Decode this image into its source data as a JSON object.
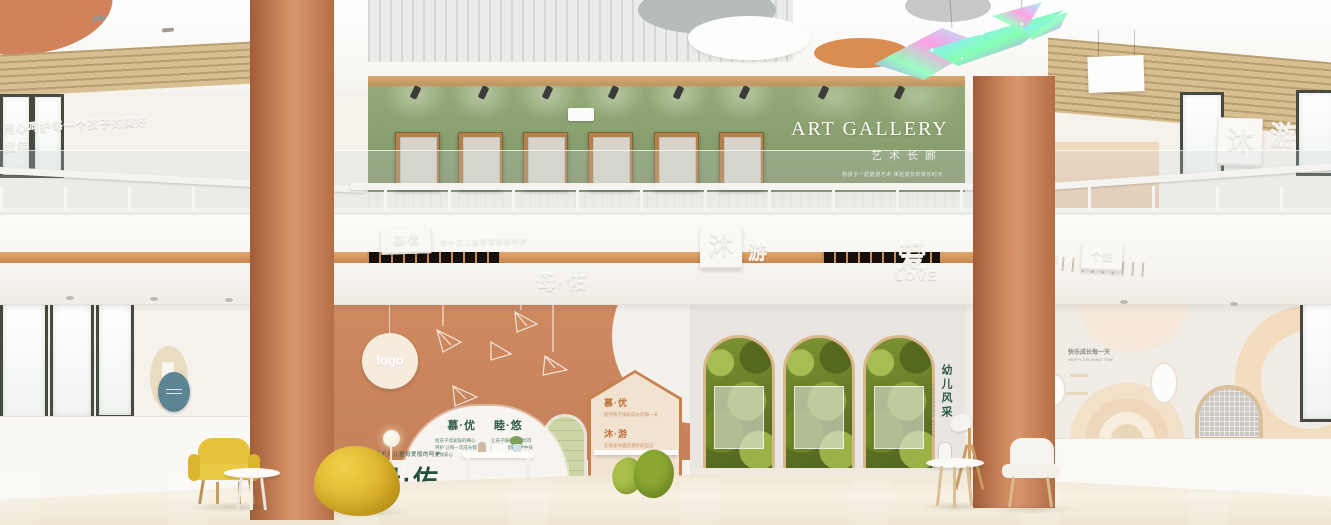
{
  "palette": {
    "accent_orange": "#cf8a5f",
    "gallery_green": "#8ba06d",
    "brand_green": "#24503f",
    "stripe_orange": "#d79a66",
    "leaf_green": "#7d9433",
    "furniture_yellow": "#e6c23c"
  },
  "gallery": {
    "title": "ART GALLERY",
    "subtitle": "艺术长廊",
    "slogan": "陪孩子一起遨游艺术 体验成长的快乐时光"
  },
  "upper_floor": {
    "left_wall_slogan": "用心呵护每一个孩子的美好童年",
    "right_sign_char1": "沐",
    "right_sign_char2": "游"
  },
  "fascia": {
    "left_plaque": "慕·优",
    "left_note": "给千万儿童母爱般的呵护",
    "center_char1": "沐",
    "center_char2": "游",
    "love_char": "爱",
    "love_en": "LOVE",
    "brand": "母·佑",
    "right_chars": "成长",
    "right_en": "SUNSHINE",
    "right_plaque": "个性"
  },
  "lobby": {
    "logo": "logo",
    "dome": {
      "left_title": "慕·优",
      "right_title": "睦·悠",
      "left_text": "给孩子母爱般的细心呵护 让每一次成长都更加安心",
      "right_text": "让孩子睡得安稳玩得开心 在温暖陪伴中快乐长大"
    },
    "brand_note": "给千万儿童母爱般的呵护",
    "brand": "母·佑",
    "house": {
      "title1": "慕·优",
      "line1": "陪伴孩子快乐成长的每一天",
      "title2": "沐·游",
      "line2": "在探索中遇见更好的自己"
    },
    "kids_corner": {
      "title": "幼儿风采",
      "subtitle": "CHILDREN'S STYLE"
    },
    "right_wall": {
      "line1": "快乐成长每一天",
      "line2": "HAPPY GROWING TIME"
    }
  }
}
